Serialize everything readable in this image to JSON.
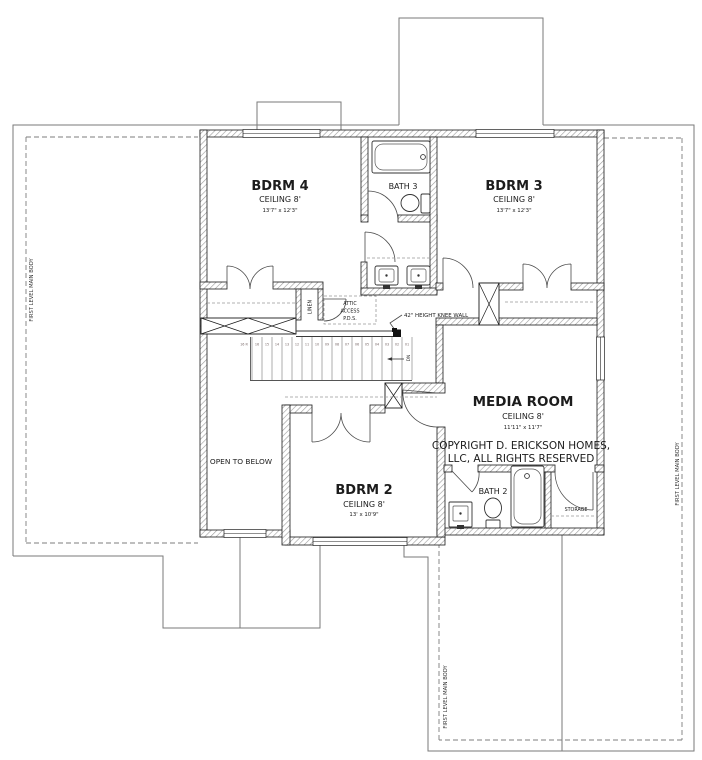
{
  "rooms": {
    "bdrm4": {
      "name": "BDRM 4",
      "ceiling": "CEILING 8'",
      "dims": "13'7\" x 12'3\""
    },
    "bdrm3": {
      "name": "BDRM 3",
      "ceiling": "CEILING 8'",
      "dims": "13'7\" x 12'3\""
    },
    "bdrm2": {
      "name": "BDRM 2",
      "ceiling": "CEILING 8'",
      "dims": "13' x 10'9\""
    },
    "media_room": {
      "name": "MEDIA ROOM",
      "ceiling": "CEILING 8'",
      "dims": "11'11\" x 11'7\""
    },
    "bath3": {
      "name": "BATH 3"
    },
    "bath2": {
      "name": "BATH 2"
    },
    "storage": {
      "name": "STORAGE"
    },
    "linen": {
      "name": "LINEN"
    },
    "open_to_below": {
      "name": "OPEN TO BELOW"
    }
  },
  "annotations": {
    "attic_line1": "ATTIC",
    "attic_line2": "ACCESS",
    "attic_line3": "P.D.S.",
    "knee_wall": "42\" HEIGHT KNEE WALL",
    "first_level_main_body": "FIRST LEVEL MAIN BODY",
    "copyright_line1": "COPYRIGHT D. ERICKSON HOMES,",
    "copyright_line2": "LLC, ALL RIGHTS RESERVED",
    "stair_direction": "DN"
  },
  "stairs": {
    "riser_note": "16 R",
    "tread_count": 16,
    "tread_labels": [
      "16",
      "15",
      "14",
      "13",
      "12",
      "11",
      "10",
      "09",
      "08",
      "07",
      "06",
      "05",
      "04",
      "03",
      "02",
      "01"
    ]
  },
  "colors": {
    "wall_hatch": "#9a9a9a",
    "wall_edge": "#1a1a1a",
    "outline_gray": "#7a7a7a",
    "text": "#1c1c1c"
  }
}
